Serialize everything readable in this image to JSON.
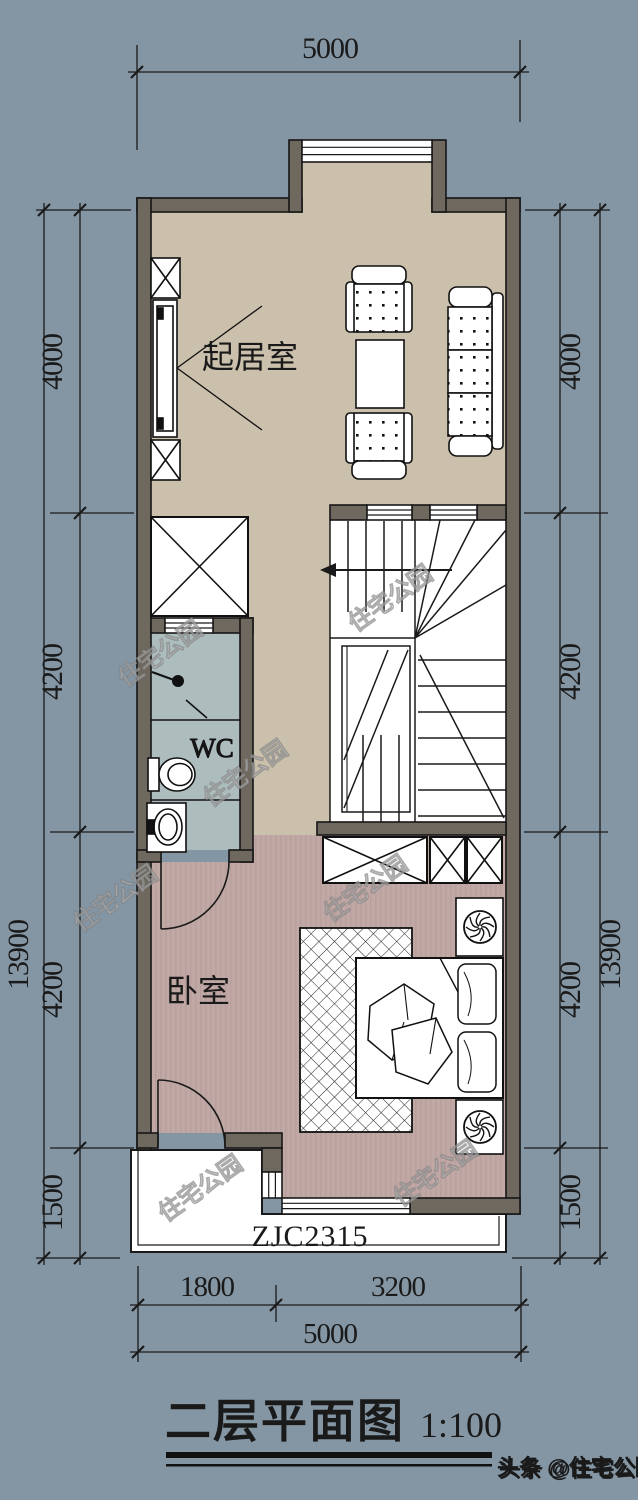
{
  "title": {
    "text": "二层平面图",
    "scale": "1:100"
  },
  "rooms": {
    "living": "起居室",
    "wc": "WC",
    "bedroom": "卧室"
  },
  "labels": {
    "balcony_window": "ZJC2315"
  },
  "dimensions": {
    "top": "5000",
    "left": [
      "4000",
      "4200",
      "4200",
      "1500"
    ],
    "left_total": "13900",
    "right": [
      "4000",
      "4200",
      "4200",
      "1500"
    ],
    "right_total": "13900",
    "bottom_row1": [
      "1800",
      "3200"
    ],
    "bottom_total": "5000"
  },
  "watermark": {
    "text": "住宅公园"
  },
  "credit": {
    "text": "头条 @住宅公园"
  },
  "colors": {
    "background": "#8496a4",
    "wall": "#6e685e",
    "floor_living": "#cbc0ac",
    "floor_bedroom": "#c0a8a5",
    "floor_wc": "#adbcbd",
    "line": "#1a1a1a"
  }
}
